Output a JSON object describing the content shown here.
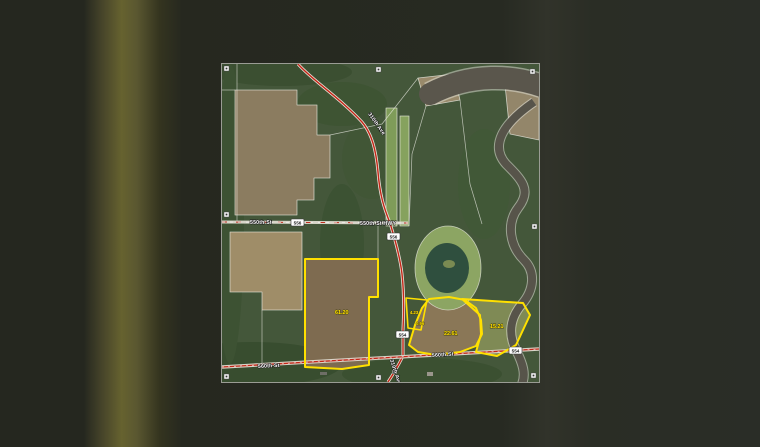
{
  "map": {
    "title": "aerial-parcel-plat-map",
    "parcels": [
      {
        "id": "west-field",
        "acres": "61.20"
      },
      {
        "id": "small-strip",
        "acres": "4.23"
      },
      {
        "id": "tiny-lot",
        "acres": "0.96"
      },
      {
        "id": "middle-field",
        "acres": "22.61"
      },
      {
        "id": "east-field",
        "acres": "15.21"
      }
    ],
    "roads": {
      "r550": "550th St",
      "r550hwy": "550th St HWY",
      "r560w": "560th St",
      "r560e": "560th St",
      "r310n": "310th Ave",
      "r310s": "310th Ave"
    },
    "badges": {
      "b1": "556",
      "b2": "556",
      "b3": "554",
      "b4": "554"
    },
    "colors": {
      "parcel_outline": "#ffe000",
      "highway_red": "#c42718",
      "water": "#5a564c",
      "pond": "#2f4f3e",
      "backdrop": "#25271f"
    }
  }
}
